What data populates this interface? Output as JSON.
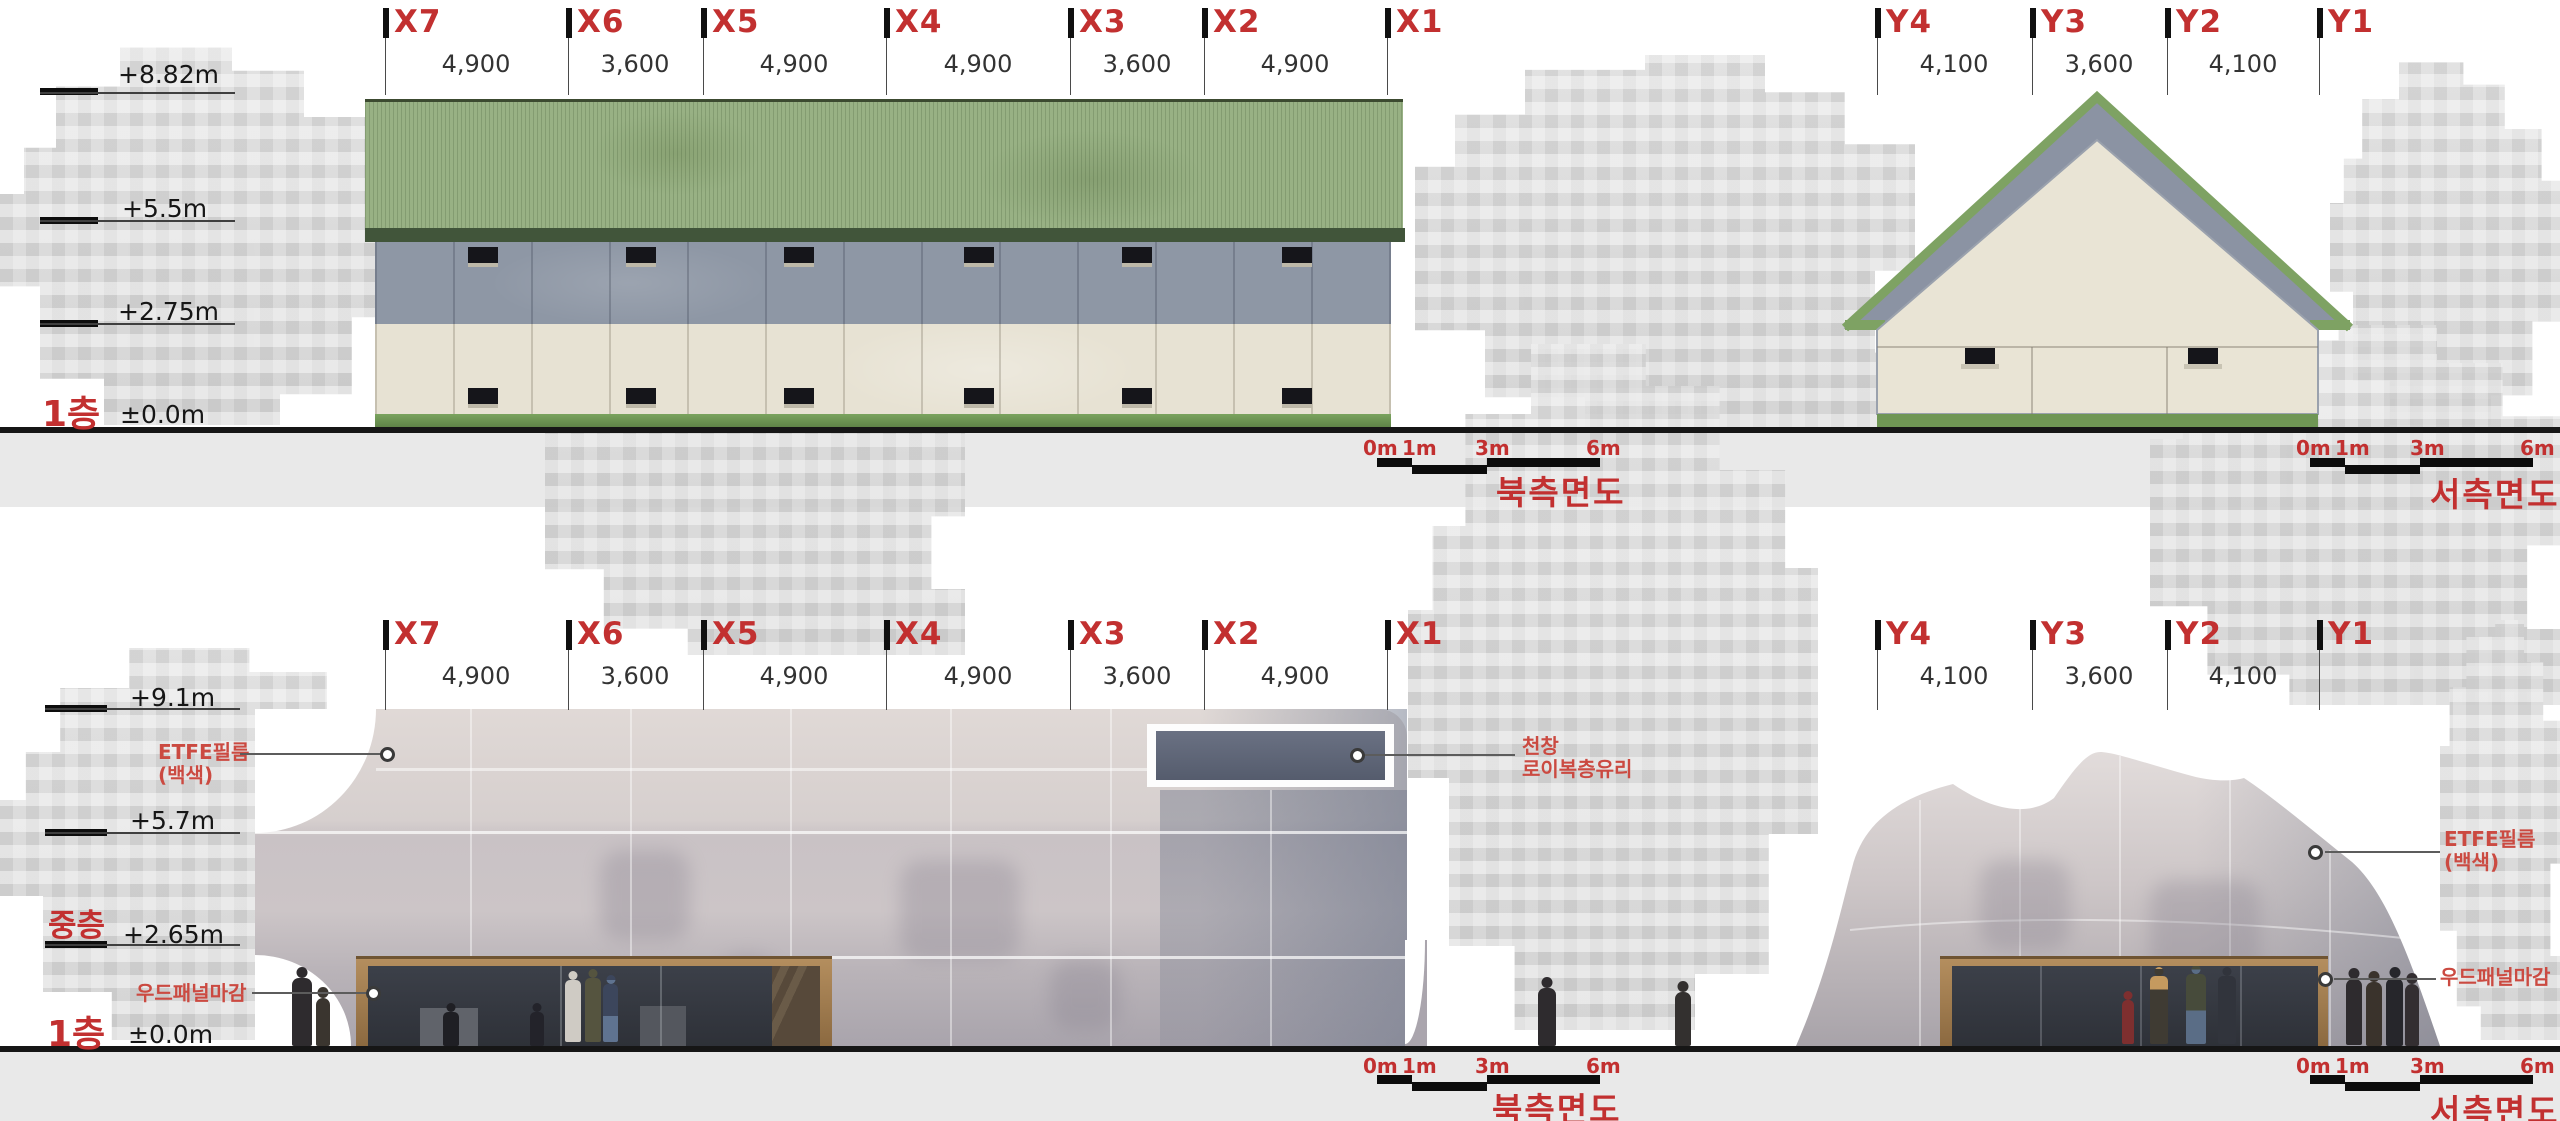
{
  "colors": {
    "grid_red": "#c23030",
    "annotation_red": "#cb4a41",
    "dimension_text": "#333333",
    "roof_green": "#98b184",
    "eave_green": "#41553a",
    "wall_slate": "#8e97a5",
    "wall_cream": "#e7e2d3",
    "grass_green": "#6f9654",
    "etfe_fabric_light": "#e0d9d6",
    "etfe_fabric_dark": "#a9a4ac",
    "wood_panel": "#9d7c50",
    "storefront_glass": "#33373f",
    "skylight_glass": "#5c6374",
    "ground_line": "#161616",
    "footer_strip": "#e9e9e9"
  },
  "top_north": {
    "grid": [
      {
        "label": "X7",
        "dim": "4,900"
      },
      {
        "label": "X6",
        "dim": "3,600"
      },
      {
        "label": "X5",
        "dim": "4,900"
      },
      {
        "label": "X4",
        "dim": "4,900"
      },
      {
        "label": "X3",
        "dim": "3,600"
      },
      {
        "label": "X2",
        "dim": "4,900"
      },
      {
        "label": "X1",
        "dim": ""
      }
    ],
    "levels": [
      {
        "text": "+8.82m"
      },
      {
        "text": "+5.5m"
      },
      {
        "text": "+2.75m"
      },
      {
        "text": "±0.0m"
      }
    ],
    "floor_label": "1층",
    "scale_labels": [
      "0m",
      "1m",
      "3m",
      "6m"
    ],
    "title": "북측면도"
  },
  "top_west": {
    "grid": [
      {
        "label": "Y4",
        "dim": "4,100"
      },
      {
        "label": "Y3",
        "dim": "3,600"
      },
      {
        "label": "Y2",
        "dim": "4,100"
      },
      {
        "label": "Y1",
        "dim": ""
      }
    ],
    "scale_labels": [
      "0m",
      "1m",
      "3m",
      "6m"
    ],
    "title": "서측면도"
  },
  "bottom_north": {
    "grid": [
      {
        "label": "X7",
        "dim": "4,900"
      },
      {
        "label": "X6",
        "dim": "3,600"
      },
      {
        "label": "X5",
        "dim": "4,900"
      },
      {
        "label": "X4",
        "dim": "4,900"
      },
      {
        "label": "X3",
        "dim": "3,600"
      },
      {
        "label": "X2",
        "dim": "4,900"
      },
      {
        "label": "X1",
        "dim": ""
      }
    ],
    "levels": [
      {
        "text": "+9.1m"
      },
      {
        "text": "+5.7m"
      },
      {
        "text": "+2.65m"
      },
      {
        "text": "±0.0m"
      }
    ],
    "floor_mezzanine": "중층",
    "floor_first": "1층",
    "ann_etfe_1": "ETFE필름",
    "ann_etfe_2": "(백색)",
    "ann_skylight_1": "천창",
    "ann_skylight_2": "로이복층유리",
    "ann_wood": "우드패널마감",
    "scale_labels": [
      "0m",
      "1m",
      "3m",
      "6m"
    ],
    "title": "북측면도"
  },
  "bottom_west": {
    "grid": [
      {
        "label": "Y4",
        "dim": "4,100"
      },
      {
        "label": "Y3",
        "dim": "3,600"
      },
      {
        "label": "Y2",
        "dim": "4,100"
      },
      {
        "label": "Y1",
        "dim": ""
      }
    ],
    "ann_etfe_1": "ETFE필름",
    "ann_etfe_2": "(백색)",
    "ann_wood": "우드패널마감",
    "scale_labels": [
      "0m",
      "1m",
      "3m",
      "6m"
    ],
    "title": "서측면도"
  }
}
